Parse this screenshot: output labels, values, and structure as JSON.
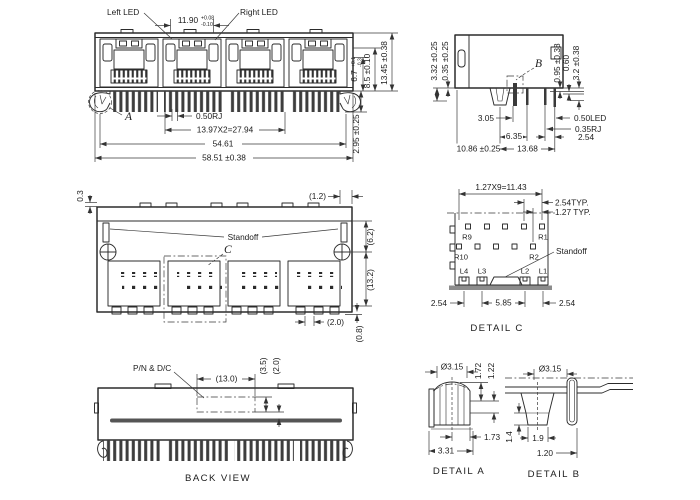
{
  "front_view": {
    "left_led": "Left LED",
    "right_led": "Right LED",
    "led_pitch": "11.90",
    "led_tol_top": "+0.08",
    "led_tol_bot": "-0.10",
    "marker_a": "A",
    "rj": "0.50RJ",
    "pitch": "13.97X2=27.94",
    "w1": "54.61",
    "w2": "58.51 ±0.38",
    "h1": "6.7",
    "h1_tol_top": "+0.1",
    "h1_tol_bot": "-0.3",
    "h2": "8.5 ±0.10",
    "h3": "13.45 ±0.38",
    "pin": "2.95 ±0.25"
  },
  "side_view": {
    "marker_b": "B",
    "left1": "3.32 ±0.25",
    "left2": "0.35 ±0.25",
    "r1": "0.95 ±0.38",
    "r2": "0.60",
    "r3": "3.2 ±0.38",
    "d305": "3.05",
    "d635": "6.35",
    "d1086": "10.86 ±0.25",
    "d1368": "13.68",
    "led": "0.50LED",
    "rj": "0.35RJ",
    "d254": "2.54"
  },
  "bottom_view": {
    "d03": "0.3",
    "d12": "(1.2)",
    "standoff": "Standoff",
    "marker_c": "C",
    "d62": "(6.2)",
    "d132": "(13.2)",
    "d20": "(2.0)",
    "d08": "(0.8)"
  },
  "detail_c": {
    "pitch": "1.27X9=11.43",
    "typ254": "2.54TYP.",
    "typ127": "1.27 TYP.",
    "r9": "R9",
    "r1": "R1",
    "r10": "R10",
    "r2": "R2",
    "standoff": "Standoff",
    "l4": "L4",
    "l3": "L3",
    "l2": "L2",
    "l1": "L1",
    "d254a": "2.54",
    "d585": "5.85",
    "d254b": "2.54",
    "caption": "DETAIL C"
  },
  "back_view": {
    "pn": "P/N & D/C",
    "d130": "(13.0)",
    "d35": "(3.5)",
    "d20": "(2.0)",
    "caption": "BACK VIEW"
  },
  "detail_a": {
    "dia": "Ø3.15",
    "d172": "1.72",
    "d122": "1.22",
    "d173": "1.73",
    "d331": "3.31",
    "caption": "DETAIL A"
  },
  "detail_b": {
    "dia": "Ø3.15",
    "d14": "1.4",
    "d19": "1.9",
    "d120": "1.20",
    "caption": "DETAIL B"
  }
}
